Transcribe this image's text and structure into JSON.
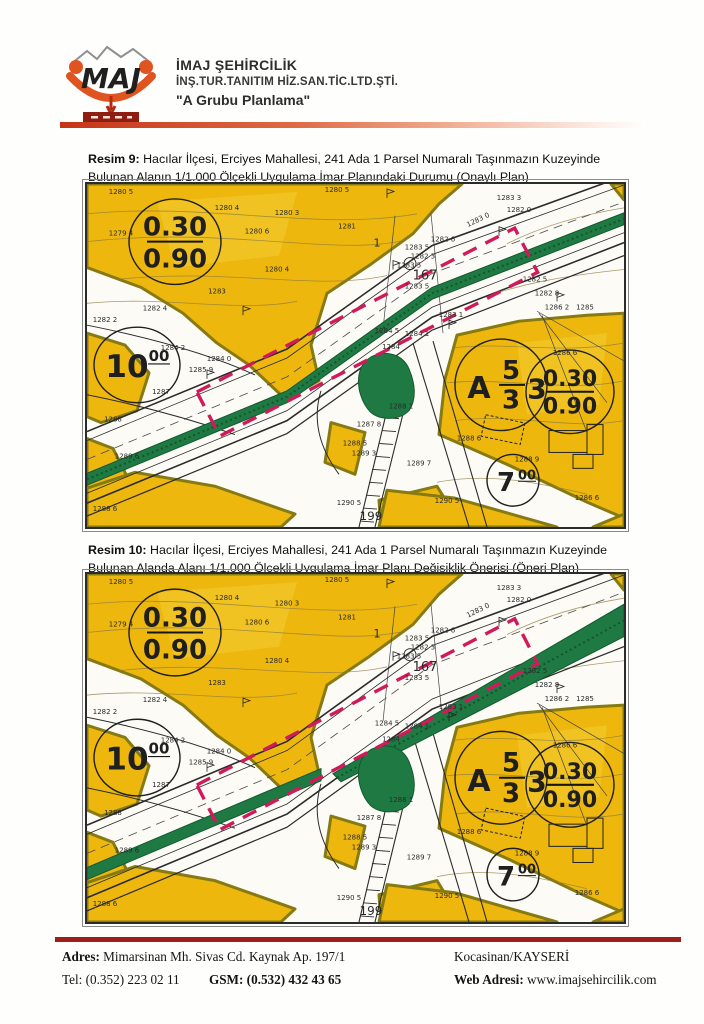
{
  "header": {
    "company_line1": "İMAJ ŞEHİRCİLİK",
    "company_line2": "İNŞ.TUR.TANITIM HİZ.SAN.TİC.LTD.ŞTİ.",
    "company_line3": "\"A Grubu Planlama\"",
    "logo_text": "MAJ"
  },
  "figures": [
    {
      "label": "Resim 9:",
      "caption": "Hacılar İlçesi, Erciyes Mahallesi, 241 Ada 1 Parsel Numaralı Taşınmazın Kuzeyinde Bulunan Alanın 1/1.000 Ölçekli Uygulama İmar Planındaki Durumu (Onaylı Plan)"
    },
    {
      "label": "Resim 10:",
      "caption": "Hacılar İlçesi, Erciyes Mahallesi, 241 Ada 1 Parsel Numaralı Taşınmazın Kuzeyinde Bulunan Alanda Alanı 1/1.000 Ölçekli Uygulama İmar Planı Değişiklik Önerisi (Öneri Plan)"
    }
  ],
  "plan_marks": {
    "ratio_top": "0.30",
    "ratio_bottom": "0.90",
    "road10": "10",
    "road10_sup": "00",
    "blockA": "A",
    "block_num": "5",
    "block_den": "3",
    "block_right": "3",
    "road7": "7",
    "road7_sup": "00"
  },
  "map_labels": [
    {
      "t": "1280 5",
      "x": 34,
      "y": 10
    },
    {
      "t": "1280 5",
      "x": 250,
      "y": 8
    },
    {
      "t": "1280 4",
      "x": 140,
      "y": 26
    },
    {
      "t": "1280 3",
      "x": 200,
      "y": 31
    },
    {
      "t": "1281",
      "x": 260,
      "y": 45
    },
    {
      "t": "1279 4",
      "x": 34,
      "y": 52
    },
    {
      "t": "1280 6",
      "x": 170,
      "y": 50
    },
    {
      "t": "1280 4",
      "x": 190,
      "y": 88
    },
    {
      "t": "1283",
      "x": 130,
      "y": 110
    },
    {
      "t": "1282 4",
      "x": 68,
      "y": 127
    },
    {
      "t": "1282 2",
      "x": 18,
      "y": 139
    },
    {
      "t": "1284 2",
      "x": 86,
      "y": 167
    },
    {
      "t": "1283 3",
      "x": 422,
      "y": 16
    },
    {
      "t": "1282 0",
      "x": 432,
      "y": 28
    },
    {
      "t": "1283 0",
      "x": 392,
      "y": 38,
      "r": -26
    },
    {
      "t": "1282 6",
      "x": 356,
      "y": 58
    },
    {
      "t": "1283 5",
      "x": 330,
      "y": 66
    },
    {
      "t": "1282 3",
      "x": 336,
      "y": 75
    },
    {
      "t": "1283 5",
      "x": 322,
      "y": 84
    },
    {
      "t": "1283 5",
      "x": 330,
      "y": 105
    },
    {
      "t": "1",
      "x": 290,
      "y": 63,
      "s": 11
    },
    {
      "t": "167",
      "x": 338,
      "y": 96,
      "s": 13
    },
    {
      "t": "1283 1",
      "x": 364,
      "y": 134
    },
    {
      "t": "1284 1",
      "x": 330,
      "y": 153
    },
    {
      "t": "1284 5",
      "x": 300,
      "y": 150
    },
    {
      "t": "1284",
      "x": 304,
      "y": 166
    },
    {
      "t": "1284 0",
      "x": 132,
      "y": 178
    },
    {
      "t": "1285 9",
      "x": 114,
      "y": 189
    },
    {
      "t": "1287",
      "x": 74,
      "y": 211
    },
    {
      "t": "1288",
      "x": 26,
      "y": 239
    },
    {
      "t": "1289 6",
      "x": 40,
      "y": 276
    },
    {
      "t": "1288 6",
      "x": 18,
      "y": 329
    },
    {
      "t": "1282 5",
      "x": 448,
      "y": 98
    },
    {
      "t": "1282 8",
      "x": 460,
      "y": 112
    },
    {
      "t": "1286 2",
      "x": 470,
      "y": 126
    },
    {
      "t": "1285",
      "x": 498,
      "y": 126
    },
    {
      "t": "1286 6",
      "x": 478,
      "y": 172
    },
    {
      "t": "1288 6",
      "x": 382,
      "y": 258
    },
    {
      "t": "1288 9",
      "x": 440,
      "y": 279
    },
    {
      "t": "1290 5",
      "x": 360,
      "y": 321
    },
    {
      "t": "1290 5",
      "x": 262,
      "y": 323
    },
    {
      "t": "1287 8",
      "x": 282,
      "y": 244
    },
    {
      "t": "1288 5",
      "x": 268,
      "y": 263
    },
    {
      "t": "1289 3",
      "x": 277,
      "y": 273
    },
    {
      "t": "1289 7",
      "x": 332,
      "y": 283
    },
    {
      "t": "1288 1",
      "x": 314,
      "y": 226
    },
    {
      "t": "199",
      "x": 284,
      "y": 338,
      "s": 12
    },
    {
      "t": "1286 6",
      "x": 500,
      "y": 318
    }
  ],
  "footer": {
    "address_label": "Adres:",
    "address": "Mimarsinan Mh. Sivas Cd. Kaynak Ap. 197/1",
    "tel_label": "Tel:",
    "tel": "(0.352) 223 02 11",
    "gsm_label": "GSM:",
    "gsm": "(0.532) 432 43 65",
    "city": "Kocasinan/KAYSERİ",
    "web_label": "Web Adresi:",
    "web": "www.imajsehircilik.com"
  },
  "colors": {
    "parcel_yellow": "#edb70e",
    "parcel_border": "#867a12",
    "green_area": "#1e7a42",
    "boundary_magenta": "#d01a5a",
    "accent_orange": "#d84315",
    "footer_bar_red": "#9d1f1c"
  }
}
